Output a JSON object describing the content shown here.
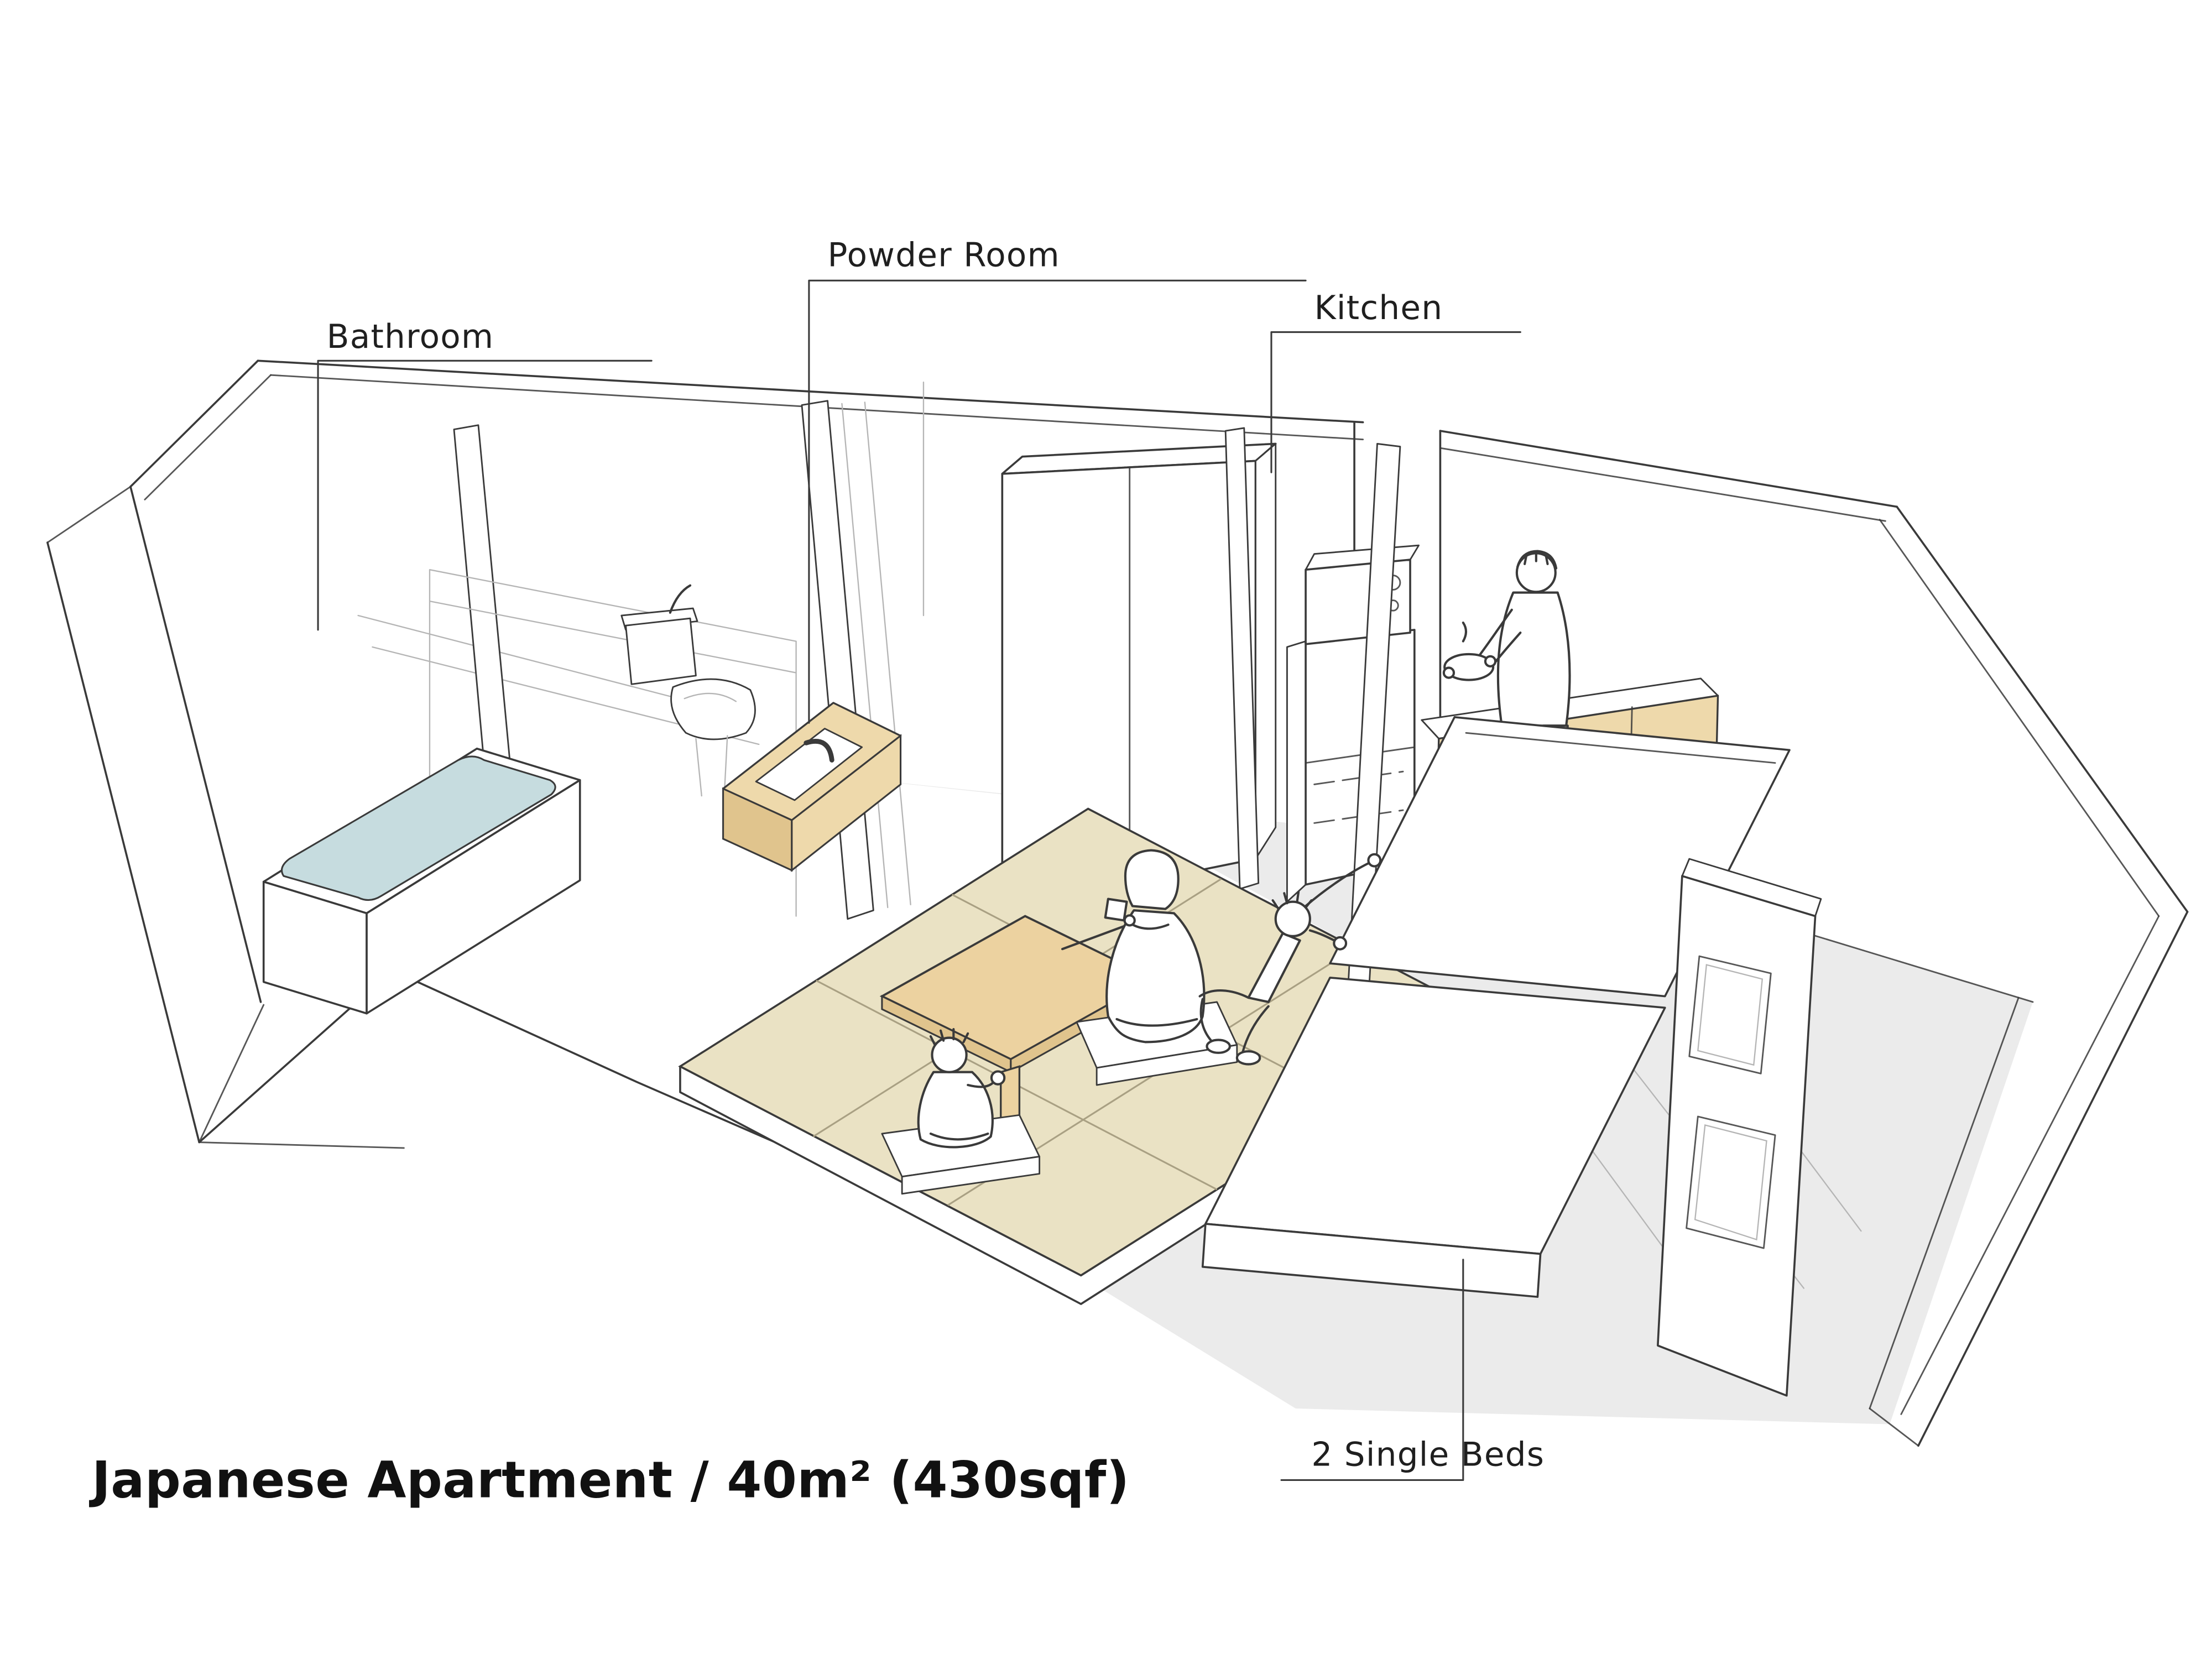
{
  "title": {
    "text": "Japanese Apartment / 40m² (430sqf)"
  },
  "labels": {
    "bathroom": "Bathroom",
    "powder_room": "Powder Room",
    "kitchen": "Kitchen",
    "beds": "2 Single Beds"
  },
  "colors": {
    "ink": "#3a3a3a",
    "label-ink": "#1f1f1f",
    "bath-water": "#c6dcdf",
    "tatami": "#eae2c4",
    "wood": "#eed9ab",
    "table-wood": "#ecd2a0",
    "floor-gray": "#ebebeb",
    "paper": "#ffffff"
  },
  "scene": {
    "type": "axonometric-cutaway-apartment-sketch",
    "rooms_labeled": [
      "Bathroom",
      "Powder Room",
      "Kitchen",
      "2 Single Beds"
    ],
    "figures": [
      "man-cooking-in-kitchen",
      "woman-drinking-tea-at-low-table",
      "child-sitting-at-low-table",
      "child-climbing-on-bed"
    ],
    "furniture": [
      "bathtub-with-water",
      "toilet",
      "wash-basin-counter",
      "wardrobe-closet",
      "refrigerator",
      "microwave",
      "kitchen-counter",
      "low-table",
      "floor-cushions",
      "tatami-platform",
      "two-single-beds",
      "bed-headboard-frames"
    ]
  }
}
